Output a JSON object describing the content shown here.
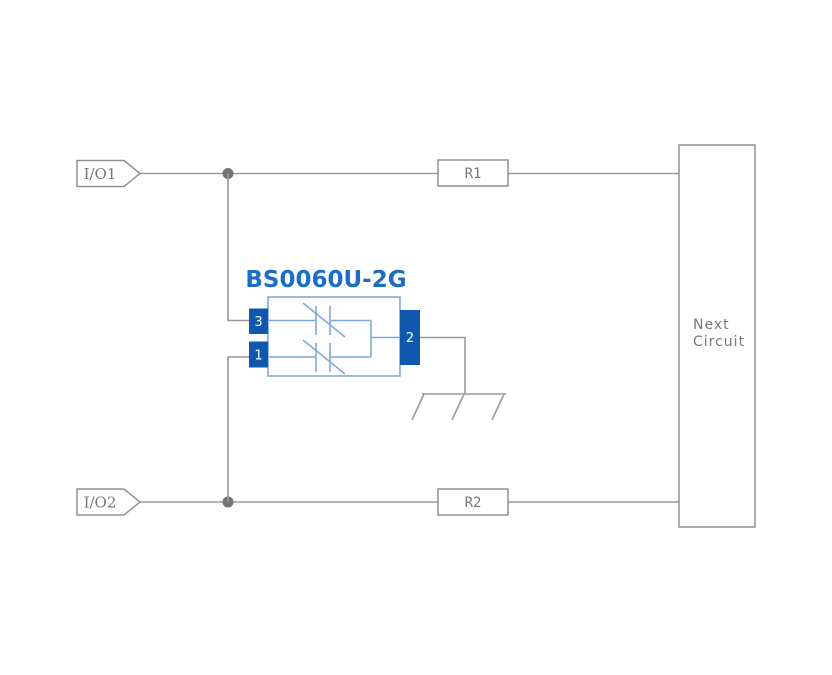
{
  "diagram": {
    "component": {
      "title": "BS0060U-2G",
      "pin_top_left": "3",
      "pin_bottom_left": "1",
      "pin_right": "2"
    },
    "io1": {
      "label": "I/O1"
    },
    "io2": {
      "label": "I/O2"
    },
    "r1": {
      "label": "R1"
    },
    "r2": {
      "label": "R2"
    },
    "next_circuit": {
      "line1": "Next",
      "line2": "Circuit"
    },
    "colors": {
      "background": "#ffffff",
      "wire_gray": "#98999b",
      "box_border_gray": "#8f9193",
      "text_gray": "#77787a",
      "junction_gray": "#737476",
      "pin_blue": "#0e58b0",
      "title_blue": "#1a6ec8",
      "symbol_light_blue": "#7ea9dc"
    }
  }
}
